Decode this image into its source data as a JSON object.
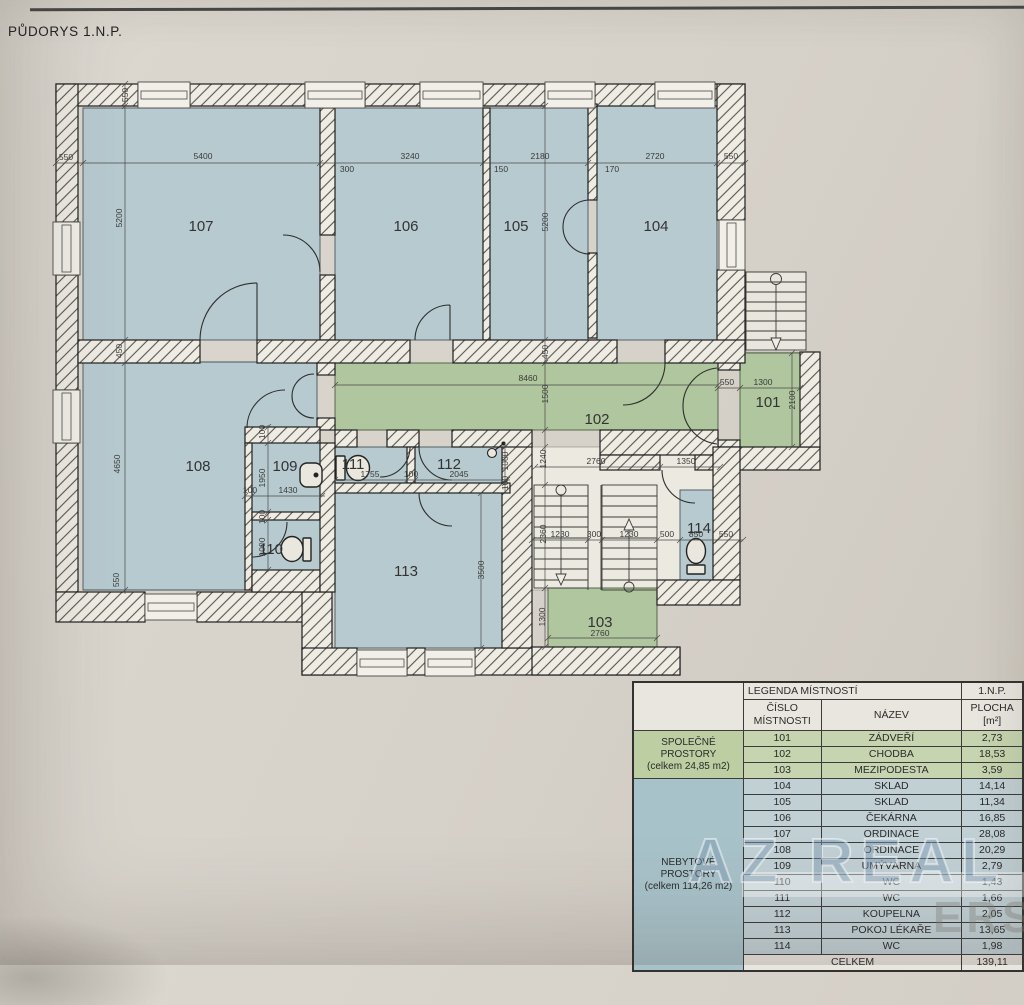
{
  "title": "PŮDORYS 1.N.P.",
  "colors": {
    "room_blue": "#b7cad0",
    "room_green": "#afc69e",
    "legend_green": "#c6d4af",
    "legend_green_dark": "#bccea2",
    "legend_blue": "#c1d0d5",
    "legend_blue_dark": "#a8c2c9"
  },
  "watermark": {
    "primary": "AZ REAL",
    "secondary": "ERS"
  },
  "plan": {
    "rooms": [
      {
        "id": "101",
        "x": 768,
        "y": 407
      },
      {
        "id": "102",
        "x": 597,
        "y": 424
      },
      {
        "id": "103",
        "x": 600,
        "y": 627
      },
      {
        "id": "104",
        "x": 656,
        "y": 231
      },
      {
        "id": "105",
        "x": 516,
        "y": 231
      },
      {
        "id": "106",
        "x": 406,
        "y": 231
      },
      {
        "id": "107",
        "x": 201,
        "y": 231
      },
      {
        "id": "108",
        "x": 198,
        "y": 471
      },
      {
        "id": "109",
        "x": 285,
        "y": 471
      },
      {
        "id": "110",
        "x": 271,
        "y": 554
      },
      {
        "id": "111",
        "x": 353,
        "y": 469
      },
      {
        "id": "112",
        "x": 449,
        "y": 469
      },
      {
        "id": "113",
        "x": 406,
        "y": 576
      },
      {
        "id": "114",
        "x": 699,
        "y": 533
      }
    ],
    "dims": [
      {
        "t": "550",
        "x": 66,
        "y": 160
      },
      {
        "t": "5400",
        "x": 203,
        "y": 159
      },
      {
        "t": "3240",
        "x": 410,
        "y": 159
      },
      {
        "t": "2180",
        "x": 540,
        "y": 159
      },
      {
        "t": "2720",
        "x": 655,
        "y": 159
      },
      {
        "t": "550",
        "x": 731,
        "y": 159
      },
      {
        "t": "300",
        "x": 347,
        "y": 172
      },
      {
        "t": "150",
        "x": 501,
        "y": 172
      },
      {
        "t": "170",
        "x": 612,
        "y": 172
      },
      {
        "t": "550",
        "x": 128,
        "y": 95,
        "r": 1
      },
      {
        "t": "5200",
        "x": 122,
        "y": 218,
        "r": 1
      },
      {
        "t": "450",
        "x": 122,
        "y": 351,
        "r": 1
      },
      {
        "t": "4650",
        "x": 120,
        "y": 464,
        "r": 1
      },
      {
        "t": "550",
        "x": 119,
        "y": 580,
        "r": 1
      },
      {
        "t": "8460",
        "x": 528,
        "y": 381
      },
      {
        "t": "5200",
        "x": 548,
        "y": 222,
        "r": 1
      },
      {
        "t": "450",
        "x": 548,
        "y": 352,
        "r": 1
      },
      {
        "t": "1500",
        "x": 548,
        "y": 394,
        "r": 1
      },
      {
        "t": "1240",
        "x": 546,
        "y": 459,
        "r": 1
      },
      {
        "t": "2360",
        "x": 546,
        "y": 534,
        "r": 1
      },
      {
        "t": "1300",
        "x": 545,
        "y": 617,
        "r": 1
      },
      {
        "t": "100",
        "x": 265,
        "y": 432,
        "r": 1
      },
      {
        "t": "1950",
        "x": 265,
        "y": 478,
        "r": 1
      },
      {
        "t": "100",
        "x": 265,
        "y": 517,
        "r": 1
      },
      {
        "t": "1000",
        "x": 265,
        "y": 547,
        "r": 1
      },
      {
        "t": "100",
        "x": 250,
        "y": 493
      },
      {
        "t": "1430",
        "x": 288,
        "y": 493
      },
      {
        "t": "1755",
        "x": 370,
        "y": 477
      },
      {
        "t": "100",
        "x": 411,
        "y": 477
      },
      {
        "t": "2045",
        "x": 459,
        "y": 477
      },
      {
        "t": "1000",
        "x": 508,
        "y": 461,
        "r": 1
      },
      {
        "t": "100",
        "x": 508,
        "y": 483,
        "r": 1
      },
      {
        "t": "3500",
        "x": 484,
        "y": 570,
        "r": 1
      },
      {
        "t": "1230",
        "x": 560,
        "y": 537
      },
      {
        "t": "300",
        "x": 594,
        "y": 537
      },
      {
        "t": "1230",
        "x": 629,
        "y": 537
      },
      {
        "t": "500",
        "x": 667,
        "y": 537
      },
      {
        "t": "850",
        "x": 696,
        "y": 537
      },
      {
        "t": "550",
        "x": 726,
        "y": 537
      },
      {
        "t": "2760",
        "x": 600,
        "y": 636
      },
      {
        "t": "2760",
        "x": 596,
        "y": 464
      },
      {
        "t": "1350",
        "x": 686,
        "y": 464
      },
      {
        "t": "550",
        "x": 727,
        "y": 385
      },
      {
        "t": "1300",
        "x": 763,
        "y": 385
      },
      {
        "t": "2100",
        "x": 795,
        "y": 400,
        "r": 1
      }
    ]
  },
  "legend": {
    "header": {
      "title": "LEGENDA MÍSTNOSTÍ",
      "floor": "1.N.P.",
      "col_cislo": "ČÍSLO MÍSTNOSTI",
      "col_nazev": "NÁZEV",
      "col_plocha": "PLOCHA",
      "col_plocha_unit": "[m²]"
    },
    "groups": {
      "spolecne": {
        "lines": [
          "SPOLEČNÉ",
          "PROSTORY",
          "(celkem 24,85 m2)"
        ]
      },
      "nebytove": {
        "lines": [
          "NEBYTOVÉ",
          "PROSTORY",
          "(celkem 114,26 m2)"
        ]
      }
    },
    "rows": [
      {
        "cislo": "101",
        "nazev": "ZÁDVEŘÍ",
        "plocha": "2,73",
        "group": "spolecne"
      },
      {
        "cislo": "102",
        "nazev": "CHODBA",
        "plocha": "18,53",
        "group": "spolecne"
      },
      {
        "cislo": "103",
        "nazev": "MEZIPODESTA",
        "plocha": "3,59",
        "group": "spolecne"
      },
      {
        "cislo": "104",
        "nazev": "SKLAD",
        "plocha": "14,14",
        "group": "nebytove"
      },
      {
        "cislo": "105",
        "nazev": "SKLAD",
        "plocha": "11,34",
        "group": "nebytove"
      },
      {
        "cislo": "106",
        "nazev": "ČEKÁRNA",
        "plocha": "16,85",
        "group": "nebytove"
      },
      {
        "cislo": "107",
        "nazev": "ORDINACE",
        "plocha": "28,08",
        "group": "nebytove"
      },
      {
        "cislo": "108",
        "nazev": "ORDINACE",
        "plocha": "20,29",
        "group": "nebytove"
      },
      {
        "cislo": "109",
        "nazev": "UMÝVÁRNA",
        "plocha": "2,79",
        "group": "nebytove"
      },
      {
        "cislo": "110",
        "nazev": "WC",
        "plocha": "1,43",
        "group": "nebytove"
      },
      {
        "cislo": "111",
        "nazev": "WC",
        "plocha": "1,66",
        "group": "nebytove"
      },
      {
        "cislo": "112",
        "nazev": "KOUPELNA",
        "plocha": "2,05",
        "group": "nebytove"
      },
      {
        "cislo": "113",
        "nazev": "POKOJ LÉKAŘE",
        "plocha": "13,65",
        "group": "nebytove"
      },
      {
        "cislo": "114",
        "nazev": "WC",
        "plocha": "1,98",
        "group": "nebytove"
      }
    ],
    "total": {
      "label": "CELKEM",
      "value": "139,11"
    }
  }
}
